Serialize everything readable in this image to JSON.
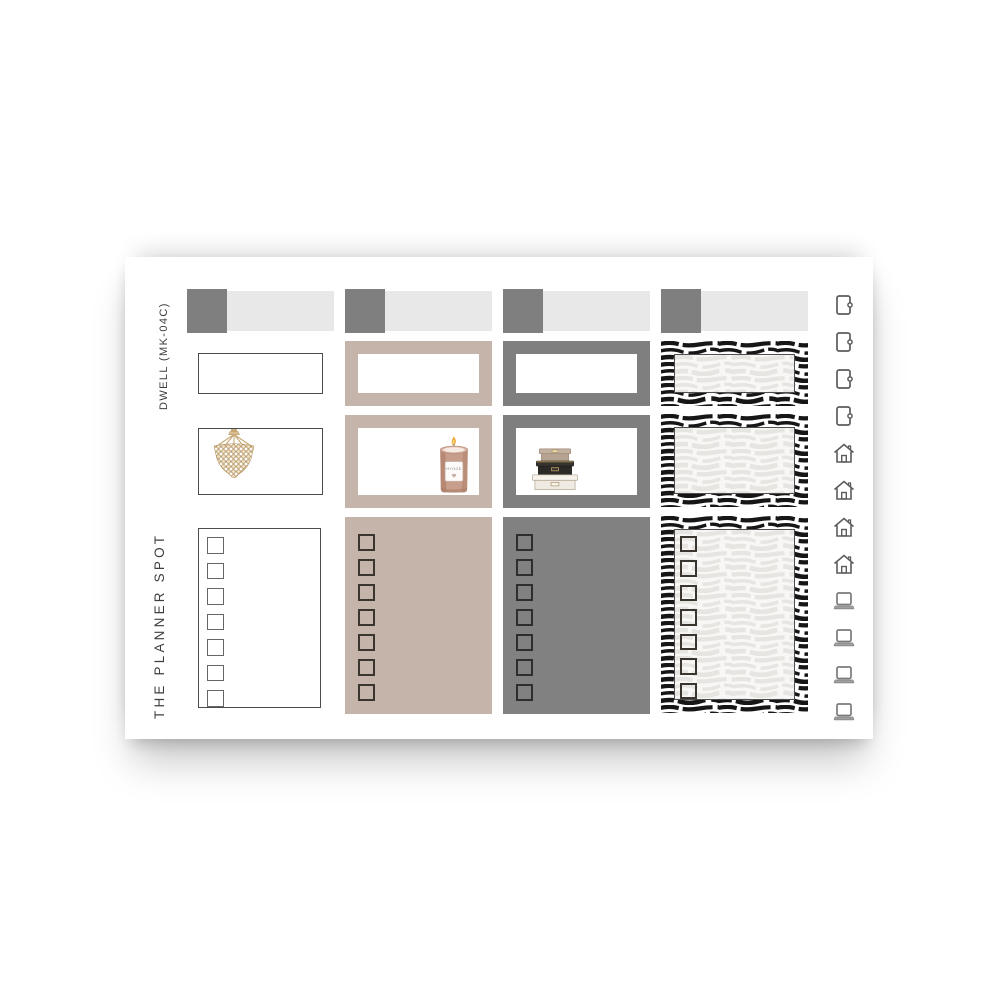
{
  "product_sheet": {
    "code_label": "DWELL (MK-04C)",
    "brand_label": "THE PLANNER SPOT",
    "candle_label": "HYGGE",
    "colors": {
      "taupe": "#c5b4a9",
      "gray": "#7f7f7f",
      "header_square_gray": "#7f7f7f",
      "header_bar_light_gray": "#e8e8e8",
      "outline_dark": "#4c4c4c",
      "zebra_black": "#161616",
      "gold": "#c2a264",
      "candle_copper": "#c79d8b"
    },
    "columns": [
      {
        "name": "white-outline",
        "header_bar": true,
        "label_box": true,
        "half_box_illustration": "beaded-chandelier",
        "checklist_checkboxes": 7
      },
      {
        "name": "taupe",
        "header_bar": true,
        "label_box": true,
        "half_box_illustration": "hygge-candle",
        "checklist_checkboxes": 7
      },
      {
        "name": "gray",
        "header_bar": true,
        "label_box": true,
        "half_box_illustration": "stacked-storage-boxes",
        "checklist_checkboxes": 7
      },
      {
        "name": "zebra-print",
        "header_bar": true,
        "label_box": true,
        "half_box_illustration": "none",
        "checklist_checkboxes": 7
      }
    ],
    "icon_strip": [
      {
        "icon": "door-icon",
        "count": 4
      },
      {
        "icon": "house-icon",
        "count": 4
      },
      {
        "icon": "laptop-icon",
        "count": 4
      }
    ]
  }
}
